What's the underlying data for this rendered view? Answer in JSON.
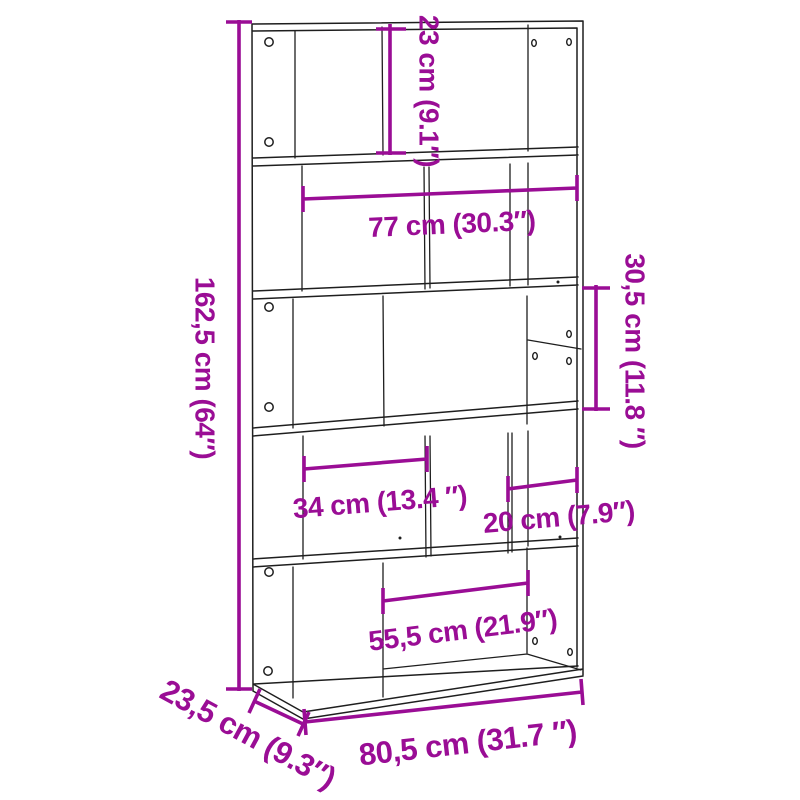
{
  "colors": {
    "dimension": "#9A0D95",
    "line_art": "#1E1E1E",
    "background": "#ffffff"
  },
  "diagram": {
    "subject": "5-tier bookcase line drawing with dimension annotations",
    "labels": {
      "tier1_height": "23 cm (9.1″)",
      "inner_width": "77 cm (30.3″)",
      "total_height": "162,5 cm (64″)",
      "tier3_height": "30,5 cm (11.8 ″)",
      "left_section_width": "34 cm (13.4 ″)",
      "right_section_width": "20 cm (7.9″)",
      "bottom_section_width": "55,5 cm (21.9″)",
      "depth": "23,5 cm (9.3″)",
      "total_width": "80,5 cm (31.7 ″)"
    }
  }
}
